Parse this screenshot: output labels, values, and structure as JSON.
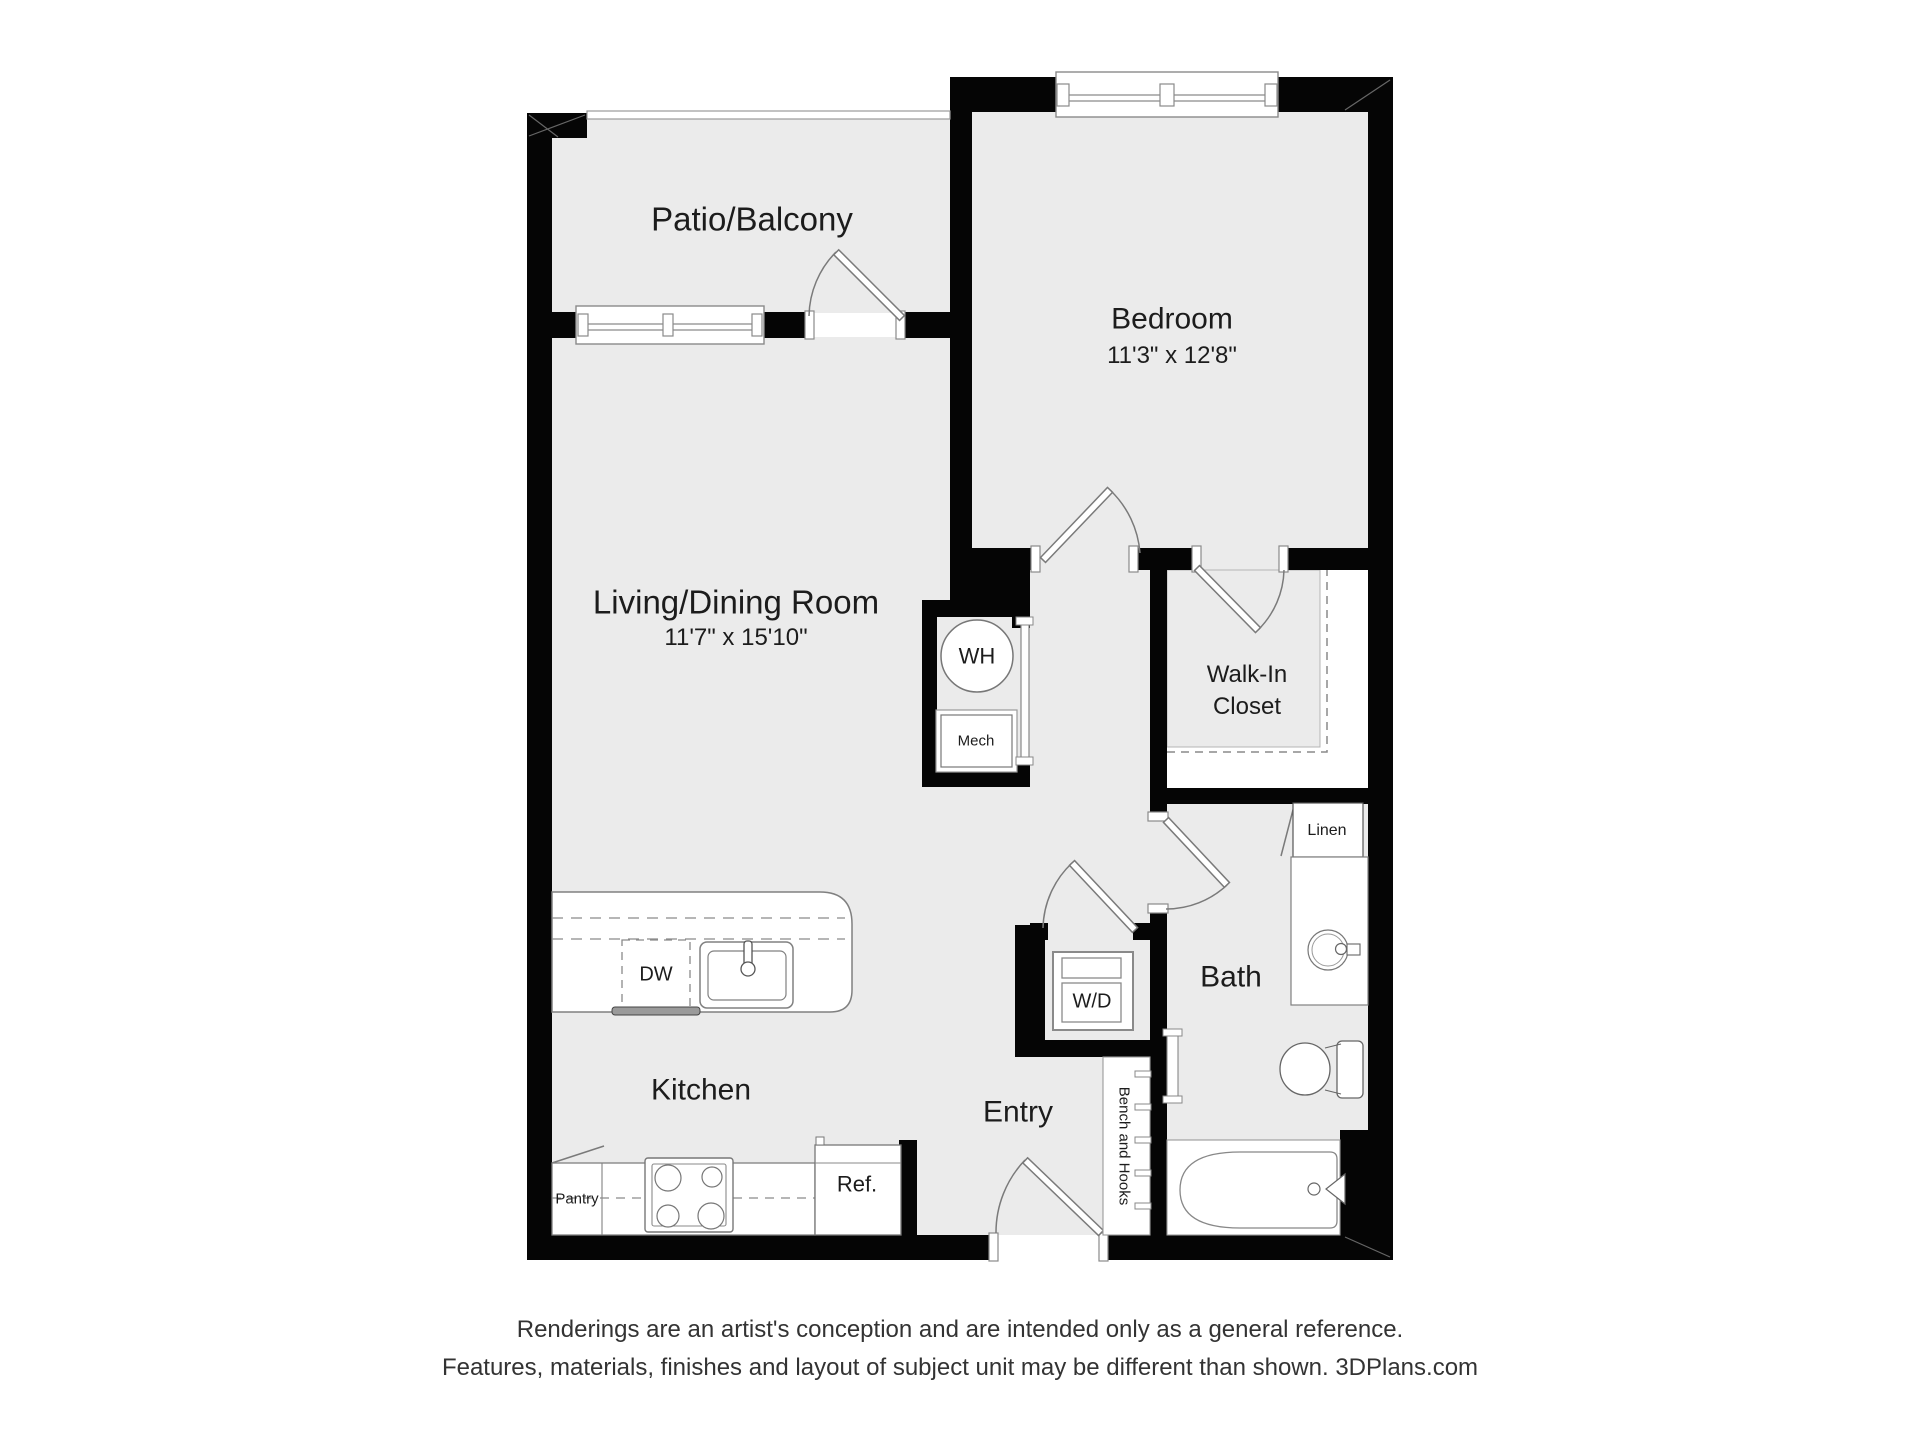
{
  "plan": {
    "rooms": {
      "patio": {
        "label": "Patio/Balcony"
      },
      "bedroom": {
        "label": "Bedroom",
        "dims": "11'3\" x 12'8\""
      },
      "living": {
        "label": "Living/Dining Room",
        "dims": "11'7\" x 15'10\""
      },
      "walk_in_closet": {
        "label": "Walk-In\nCloset"
      },
      "bath": {
        "label": "Bath"
      },
      "kitchen": {
        "label": "Kitchen"
      },
      "entry": {
        "label": "Entry"
      }
    },
    "fixtures": {
      "water_heater": "WH",
      "mechanical": "Mech",
      "linen": "Linen",
      "dishwasher": "DW",
      "washer_dryer": "W/D",
      "bench_hooks": "Bench and Hooks",
      "pantry": "Pantry",
      "refrigerator": "Ref."
    },
    "colors": {
      "floor": "#ebebeb",
      "wall": "#050505",
      "line": "#7a7a7a"
    }
  },
  "footer": {
    "line1": "Renderings are an artist's conception and are intended only as a general reference.",
    "line2": "Features, materials, finishes and layout of subject unit may be different than shown. 3DPlans.com"
  }
}
